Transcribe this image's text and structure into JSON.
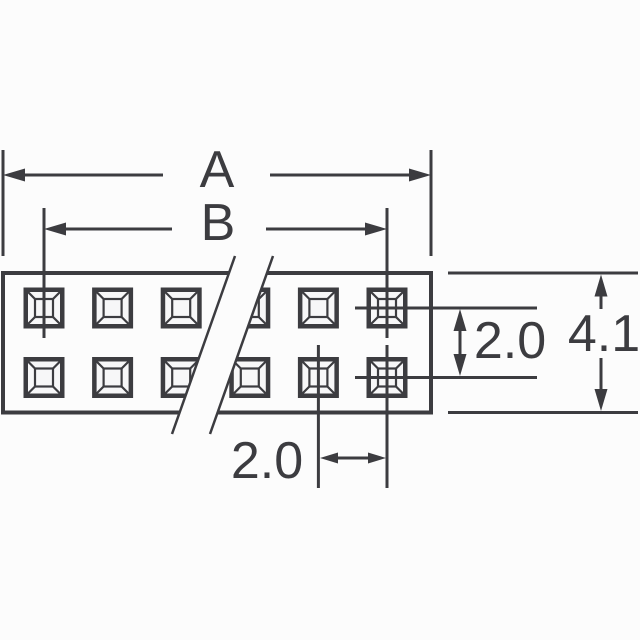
{
  "drawing": {
    "dimensions": {
      "overall_width_label": "A",
      "contact_span_label": "B",
      "row_pitch_label": "2.0",
      "overall_height_label": "4.1",
      "column_pitch_label": "2.0"
    },
    "connector": {
      "rows": 2,
      "columns": 6
    },
    "colors": {
      "ink": "#3c3c40",
      "background": "#fcfcfc",
      "pin_fill": "#f7f7f8"
    }
  }
}
